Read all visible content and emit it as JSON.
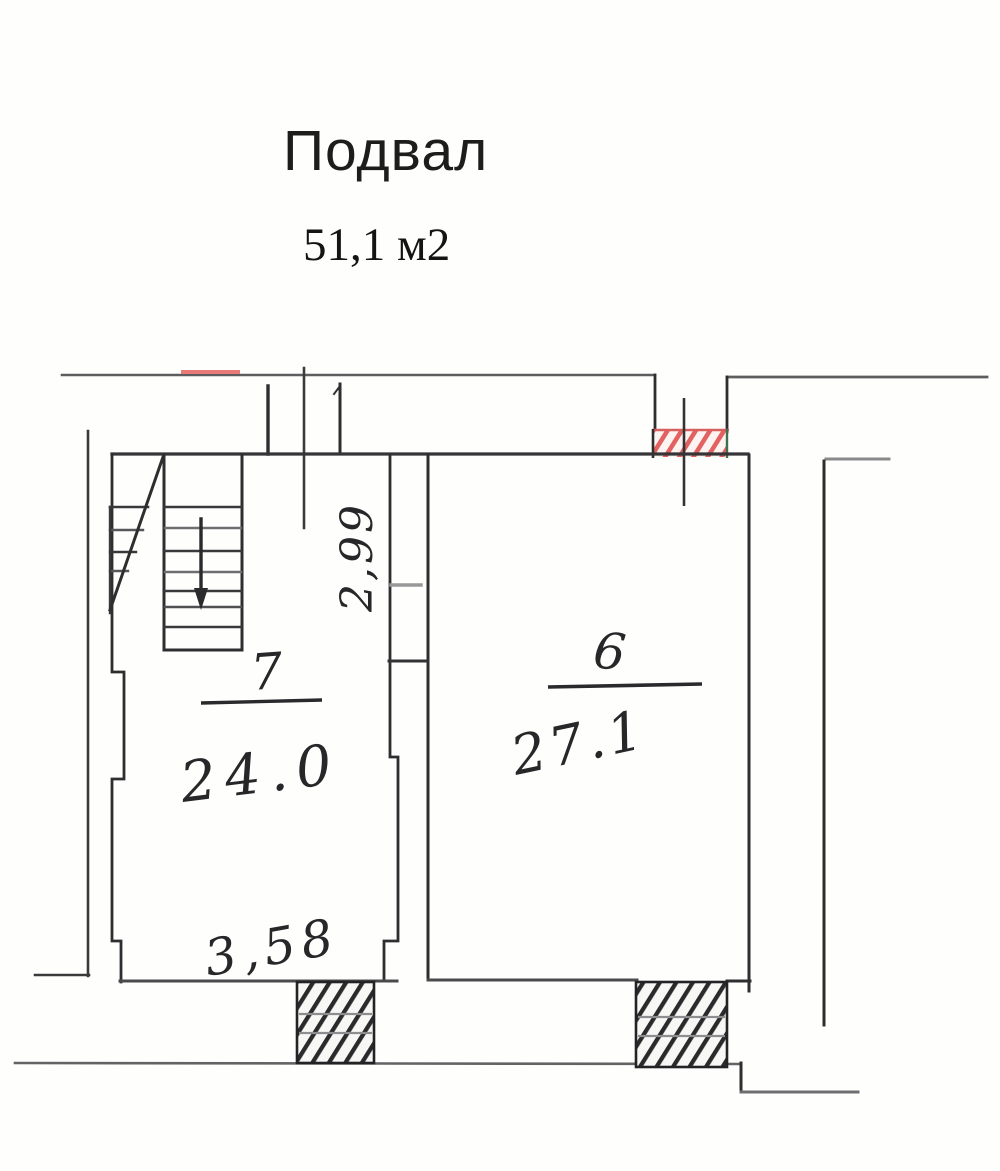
{
  "header": {
    "title": "Подвал",
    "area_total": "51,1 м2"
  },
  "plan": {
    "floor_name": "Подвал",
    "rooms": [
      {
        "number": "7",
        "area": "24.0",
        "features": [
          "staircase",
          "entrance-opening-top",
          "hatched-wall-opening-bottom"
        ]
      },
      {
        "number": "6",
        "area": "27.1",
        "features": [
          "red-hatched-opening-top",
          "hatched-wall-opening-bottom"
        ]
      }
    ],
    "dimensions": {
      "room7_width": "3,58",
      "room7_depth": "2,99"
    },
    "icons": {
      "stairs_arrow": "down-arrow-icon"
    },
    "colors": {
      "wall_dark": "#2e2e30",
      "wall_grey": "#6e6e70",
      "hatch_black": "#2a2a2c",
      "hatch_red": "#e26161",
      "red_mark": "#e87b78",
      "background": "#fefefd"
    }
  }
}
